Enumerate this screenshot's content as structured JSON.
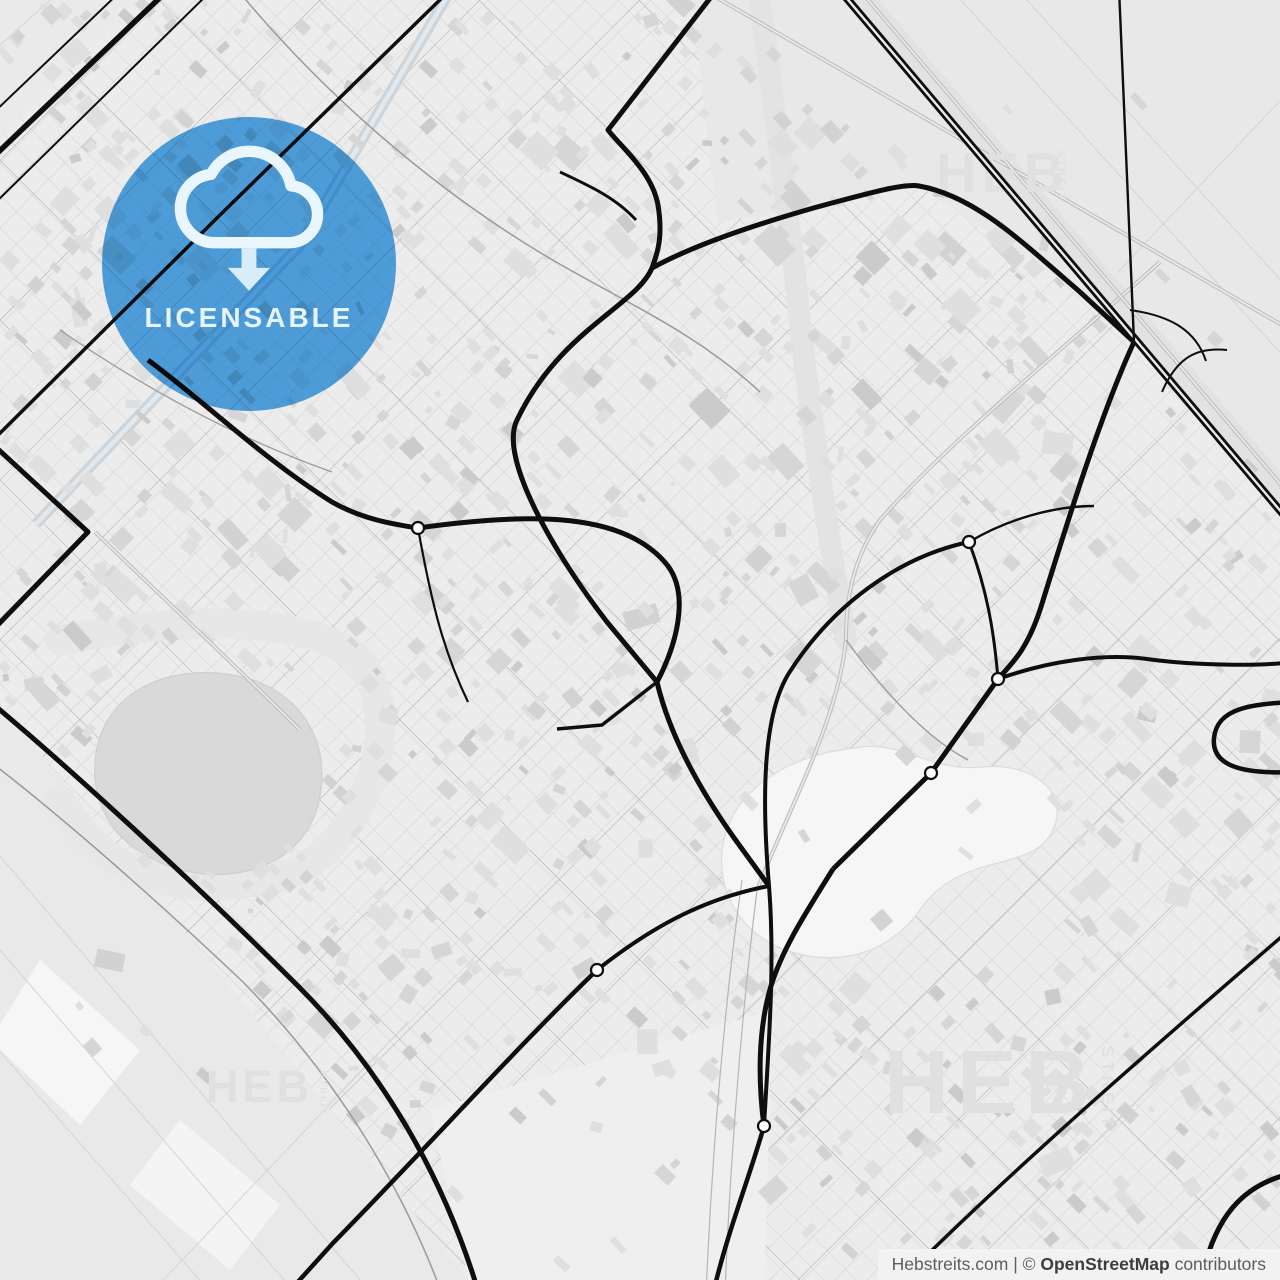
{
  "map": {
    "palette": {
      "bg": "#ececec",
      "grid_line": "#cbcbcb",
      "arterial_line": "#a9a9a9",
      "field_line": "#d4d4d4",
      "road_black": "#0e0e0e",
      "road_gray": "#9a9a9a",
      "rail": "#bdbdbd",
      "rail_gap": "#eaeaea",
      "building_colors": [
        "#dfdfdf",
        "#d6d6d6",
        "#cbcbcb",
        "#d2d2d2"
      ],
      "roundabout_fill": "#ffffff"
    },
    "fields": [
      {
        "points": "690,-12 1294,-12 1294,520 1134,342 1080,292 919,186 817,207 718,222",
        "fill": "#e8e8e8"
      },
      {
        "points": "-12,690 -12,1294 480,1294",
        "fill": "#e9e9e9"
      },
      {
        "points": "-12,-12 150,-12 -12,150",
        "fill": "#eaeaea"
      },
      {
        "points": "430,1110 772,1010 764,1294 472,1294",
        "fill": "#efefef"
      },
      {
        "points": "40,960 140,1050 80,1125 -10,1040",
        "fill": "#f6f6f6"
      },
      {
        "points": "180,1120 280,1205 230,1270 130,1185",
        "fill": "#f4f4f4"
      }
    ],
    "field_lines": [
      "M 950,-12 L 1294,368",
      "M 1016,-12 L 1294,295",
      "M 1294,86 L 1118,272",
      "M -12,842 L 372,1294",
      "M -12,936 L 296,1294",
      "M -12,1038 L 212,1294",
      "M 150,1294 L 408,1022",
      "M -12,56 L 64,-12"
    ],
    "greenways": [
      {
        "d": "M 758,-12 C 776,120 792,240 802,342 C 818,470 832,560 846,640",
        "w": 22,
        "c": "#e3e3e3"
      },
      {
        "d": "M 852,-12 L 1294,508",
        "w": 26,
        "c": "#e2e2e2"
      },
      {
        "d": "M 60,640 C 180,618 300,612 360,660 C 400,710 380,820 300,870 C 200,905 100,880 60,800",
        "w": 30,
        "c": "#e7e7e7"
      }
    ],
    "lake": {
      "d": "M 95,762 C 100,692 168,662 238,676 C 300,689 332,741 319,801 C 307,857 251,881 196,873 C 136,863 90,822 95,762 Z",
      "fill": "#d9d9d9",
      "stroke": "#cfcfcf"
    },
    "golf": {
      "d": "M 742,802 C 702,852 722,932 792,952 C 842,967 892,952 922,907 C 962,852 1032,872 1052,832 C 1072,792 1032,762 982,767 C 932,772 902,742 862,747 C 812,752 772,767 742,802 Z",
      "fill": "#f6f6f6",
      "stroke": "#dcdcdc"
    },
    "canals": [
      {
        "d": "M 36,524 L 300,245 L 452,-12",
        "w": 11,
        "c": "#cdd4da"
      },
      {
        "d": "M 36,524 L 300,245 L 452,-12",
        "w": 4.5,
        "c": "#e2e9ee"
      }
    ],
    "railways": [
      {
        "d": "M 700,-12 L 1294,332",
        "double": true
      },
      {
        "d": "M 1160,262 C 1060,352 950,440 880,520 C 852,560 846,600 846,640 C 838,720 790,806 757,890",
        "double": true
      },
      {
        "d": "M 858,-12 L 1294,500",
        "double": true
      },
      {
        "d": "M 95,532 C 165,600 235,665 300,730",
        "double": true
      },
      {
        "d": "M 742,880 C 725,1000 712,1150 706,1294",
        "double": false
      },
      {
        "d": "M 757,890 C 742,1010 730,1160 725,1294",
        "double": false
      }
    ],
    "gray_roads": [
      {
        "d": "M -12,760 C 60,815 152,896 242,981 C 330,1070 400,1180 442,1294",
        "w": 1.5
      },
      {
        "d": "M 236,-12 C 320,90 432,190 556,262 C 640,310 700,336 760,392",
        "w": 1.5
      },
      {
        "d": "M 60,330 C 150,392 242,440 332,472",
        "w": 1.3
      },
      {
        "d": "M 846,640 C 890,700 930,740 968,760",
        "w": 1.3
      }
    ],
    "roads": [
      {
        "d": "M -12,162 L 170,-12",
        "w": 5.5
      },
      {
        "d": "M -12,118 L 124,-12",
        "w": 2
      },
      {
        "d": "M -12,210 L 214,-12",
        "w": 2
      },
      {
        "d": "M -12,445 L 220,215 L 452,-12",
        "w": 3.5
      },
      {
        "d": "M -12,440 L 88,532 L -12,635",
        "w": 5
      },
      {
        "d": "M 148,360 C 205,402 262,458 332,502 C 362,519 392,524 418,528",
        "w": 5
      },
      {
        "d": "M 418,528 C 532,512 626,512 668,566 C 690,596 676,646 657,682",
        "w": 5
      },
      {
        "d": "M 718,-12 L 608,130 C 622,148 652,172 658,205 C 663,236 658,252 652,268 C 636,306 560,330 517,420 C 498,458 556,556 607,622 L 657,682",
        "w": 5
      },
      {
        "d": "M 560,172 C 590,186 616,198 636,220",
        "w": 3
      },
      {
        "d": "M 652,268 C 692,246 750,226 817,207 C 862,195 903,183 919,186 C 976,196 1024,244 1080,292 L 1134,342",
        "w": 5
      },
      {
        "d": "M 838,-12 L 1294,527",
        "w": 8,
        "dual": true
      },
      {
        "d": "M 1119,-12 C 1125,110 1130,230 1134,342",
        "w": 2.4
      },
      {
        "d": "M 1134,342 C 1098,420 1062,540 1040,610 C 1026,652 1011,664 998,679",
        "w": 5
      },
      {
        "d": "M 969,542 C 897,557 831,607 789,673 C 764,713 761,790 769,886",
        "w": 4
      },
      {
        "d": "M 969,542 C 987,590 994,631 998,679",
        "w": 3
      },
      {
        "d": "M 969,542 C 1006,520 1052,506 1094,506",
        "w": 2.4
      },
      {
        "d": "M 998,679 L 931,773 L 833,869",
        "w": 5
      },
      {
        "d": "M 657,682 C 670,737 701,792 737,842 L 769,886",
        "w": 5
      },
      {
        "d": "M 657,682 L 602,725 L 557,729",
        "w": 3.5
      },
      {
        "d": "M 833,869 C 807,911 783,947 771,986 C 758,1029 758,1081 764,1126",
        "w": 5
      },
      {
        "d": "M 769,886 C 775,961 769,1041 764,1126",
        "w": 4
      },
      {
        "d": "M 764,1126 C 749,1179 727,1233 713,1294",
        "w": 4.5
      },
      {
        "d": "M 998,679 C 1049,661 1103,653 1147,659 C 1197,666 1262,666 1294,662",
        "w": 4
      },
      {
        "d": "M 1294,702 C 1251,704 1217,708 1214,738 C 1211,768 1247,774 1294,772",
        "w": 4.5
      },
      {
        "d": "M 597,970 C 649,929 701,899 769,886",
        "w": 4
      },
      {
        "d": "M 597,970 C 521,1043 433,1141 333,1243 L 287,1294",
        "w": 4.5
      },
      {
        "d": "M -12,700 C 70,768 200,888 298,986 C 380,1068 443,1173 479,1294",
        "w": 5
      },
      {
        "d": "M 1294,926 C 1150,1050 1000,1180 888,1294",
        "w": 3.5
      },
      {
        "d": "M 1294,1173 C 1245,1183 1211,1215 1199,1294",
        "w": 5
      },
      {
        "d": "M 1130,310 C 1172,316 1196,331 1206,361",
        "w": 2
      },
      {
        "d": "M 1162,392 C 1177,357 1197,347 1227,350",
        "w": 2
      },
      {
        "d": "M 418,528 C 432,606 444,652 468,702",
        "w": 2.2
      }
    ],
    "roundabouts": [
      {
        "cx": 418,
        "cy": 528
      },
      {
        "cx": 969,
        "cy": 542
      },
      {
        "cx": 998,
        "cy": 679
      },
      {
        "cx": 931,
        "cy": 773
      },
      {
        "cx": 764,
        "cy": 1126
      },
      {
        "cx": 597,
        "cy": 970
      }
    ]
  },
  "watermarks": [
    {
      "text": "HEB",
      "x": 936,
      "y": 192,
      "size": 56,
      "ls": 5,
      "vertical": false
    },
    {
      "text": "STREIT",
      "x": 1058,
      "y": 150,
      "size": 11,
      "ls": 2,
      "vertical": true
    },
    {
      "text": "HEB",
      "x": 884,
      "y": 1113,
      "size": 90,
      "ls": 8,
      "vertical": false
    },
    {
      "text": "STREIT",
      "x": 1102,
      "y": 1046,
      "size": 17,
      "ls": 4,
      "vertical": true
    },
    {
      "text": "HEB",
      "x": 206,
      "y": 1102,
      "size": 45,
      "ls": 4,
      "vertical": false
    },
    {
      "text": "STREIT",
      "x": 320,
      "y": 1072,
      "size": 9,
      "ls": 2,
      "vertical": true
    }
  ],
  "watermark_color": "#e0e0e0",
  "badge": {
    "label": "LICENSABLE",
    "cx": 249,
    "cy": 264,
    "r": 147,
    "colors": {
      "blue": "#54a9e9",
      "cloud": "#e9f6fe",
      "arrow": "#d7eefa",
      "label": "#e6f4fd"
    }
  },
  "attribution": {
    "site": "Hebstreits.com",
    "separator": " | © ",
    "brand": "OpenStreetMap",
    "suffix": " contributors",
    "bg": "#f2f2f2",
    "text_color": "#5d5d5d",
    "brand_color": "#3d3d3d"
  }
}
